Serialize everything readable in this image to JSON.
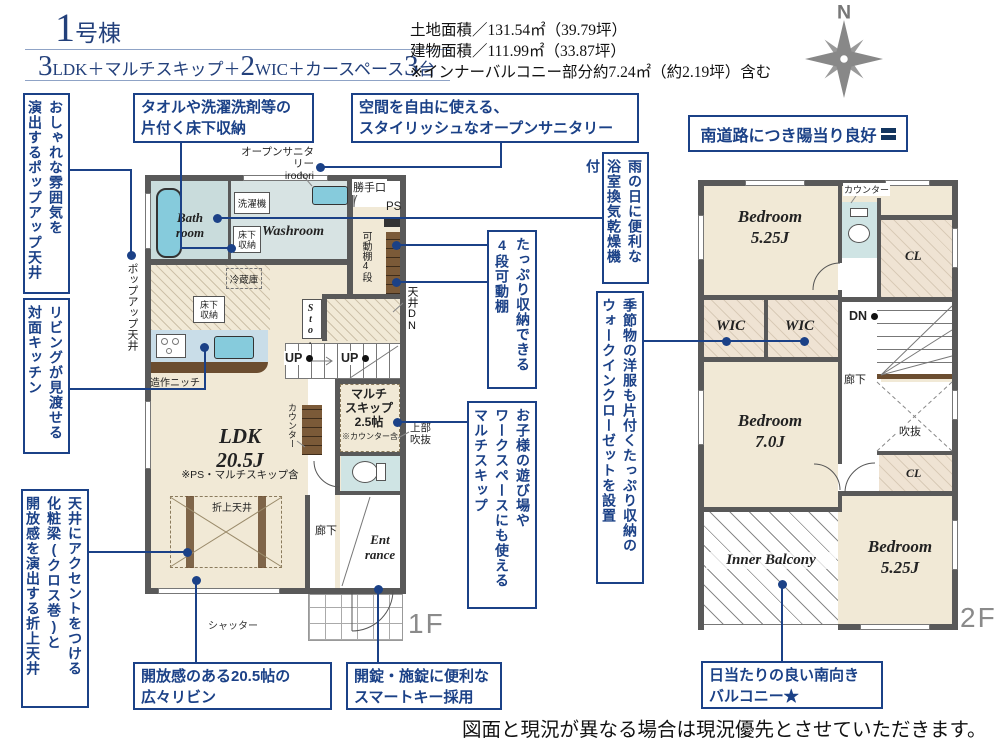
{
  "header": {
    "building_no": {
      "num": "1",
      "suffix": "号棟"
    },
    "spec_parts": [
      "3",
      "LDK＋マルチスキップ＋",
      "2",
      "WIC＋カースペース",
      "3",
      "台"
    ],
    "areas": "土地面積／131.54㎡（39.79坪）\n建物面積／111.99㎡（33.87坪）\n※インナーバルコニー部分約7.24㎡（約2.19坪）含む",
    "compass_n": "N",
    "sun_note": "南道路につき陽当り良好"
  },
  "callouts": {
    "popup_ceiling": "おしゃれな雰囲気を\n演出するポップアップ天井",
    "counter_kitchen": "リビングが見渡せる\n対面キッチン",
    "beam_ceiling": "天井にアクセントをつける\n化粧梁(クロス巻)と\n開放感を演出する折上天井",
    "underfloor": "タオルや洗濯洗剤等の\n片付く床下収納",
    "open_sanitary": "空間を自由に使える、\nスタイリッシュなオープンサニタリー",
    "bath_dryer": "雨の日に便利な\n浴室換気乾燥機付",
    "shelf": "たっぷり収納できる\n4段可動棚",
    "multi_skip": "お子様の遊び場や\nワークスペースにも使える\nマルチスキップ",
    "wic": "季節物の洋服も片付くたっぷり収納の\nウォークインクローゼットを設置",
    "living": "開放感のある20.5帖の\n広々リビン",
    "smart_key": "開錠・施錠に便利な\nスマートキー採用",
    "balcony": "日当たりの良い南向き\nバルコニー★"
  },
  "f1": {
    "floor_label": "1F",
    "bathroom": "Bath\nroom",
    "washroom": "Washroom",
    "washing_machine": "洗濯機",
    "underfloor1": "床下\n収納",
    "underfloor2": "床下\n収納",
    "fridge": "冷蔵庫",
    "back_door": "勝手口",
    "ps": "PS",
    "shelf": "可動棚4段",
    "ceiling_dn": "天井DN",
    "sto": "Sto.",
    "up1": "UP",
    "up2": "UP",
    "counter": "カウンター",
    "multi_skip": "マルチ\nスキップ\n2.5帖",
    "counter_inc": "※カウンター含",
    "upper_void": "上部\n吹抜",
    "ldk": "LDK\n20.5J",
    "ldk_note": "※PS・マルチスキップ含",
    "folded_ceiling": "折上天井",
    "niche": "造作ニッチ",
    "popup_label": "ポップアップ天井",
    "open_sanitary_label": "オープンサニタリー\nirodori",
    "hallway": "廊下",
    "entrance": "Ent\nrance",
    "shutter": "シャッター"
  },
  "f2": {
    "floor_label": "2F",
    "bedroom1": "Bedroom\n5.25J",
    "counter": "カウンター",
    "cl1": "CL",
    "wic1": "WIC",
    "wic2": "WIC",
    "dn": "DN",
    "hallway": "廊下",
    "void": "吹抜",
    "cl2": "CL",
    "bedroom2": "Bedroom\n7.0J",
    "inner_balcony": "Inner Balcony",
    "bedroom3": "Bedroom\n5.25J"
  },
  "footer": {
    "disclaimer": "図面と現況が異なる場合は現況優先とさせていただきます。"
  },
  "colors": {
    "accent_navy": "#1b4187",
    "wall_gray": "#595959",
    "floor_cream": "#f1e9d6",
    "water_blue": "#86cbdc",
    "sanitary_aqua": "#d7e3e3",
    "wood_brown": "#6b4d30",
    "floor_label_gray": "#8a8a8a"
  }
}
